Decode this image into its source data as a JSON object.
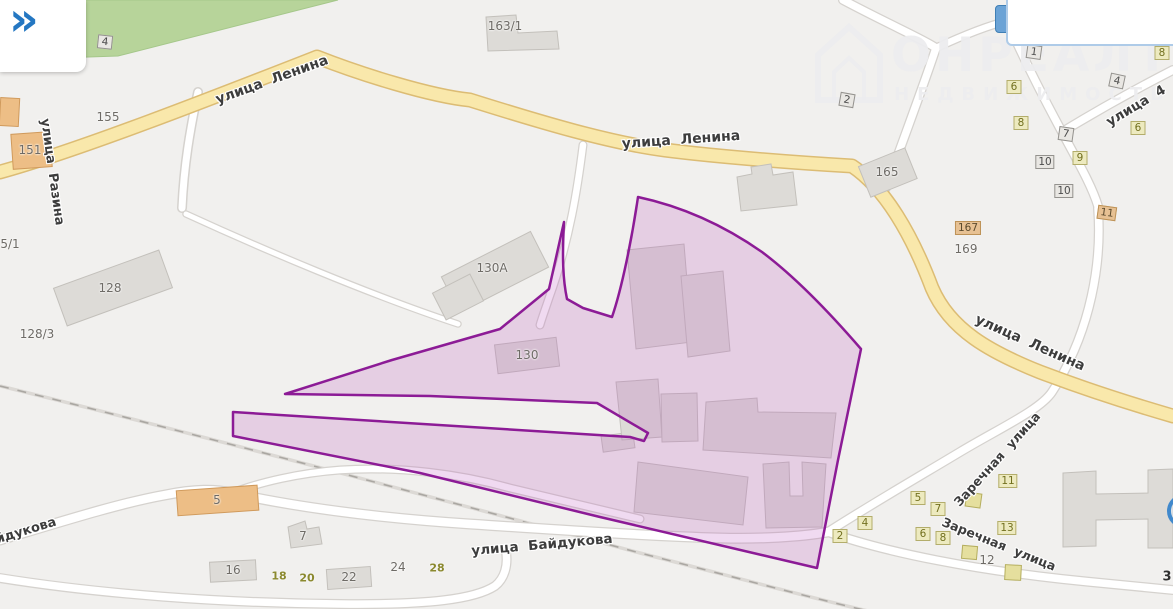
{
  "app": {
    "panel_toggle_icon": "»",
    "watermark": {
      "line1": "ОНРЕАЛТ",
      "line2": "НЕДВИЖИМОСТЬ"
    }
  },
  "colors": {
    "background": "#f1f0ee",
    "selected_area_stroke": "#8c1b96",
    "selected_area_fill": "rgba(186,85,190,0.22)",
    "road_primary_fill": "#f9e8ab",
    "road_primary_casing": "#dcbc74",
    "greenery": "#b7d49a",
    "building": "#dddbd7",
    "building_orange": "#edbe86",
    "accent_blue": "#2477c2"
  },
  "map": {
    "street_labels": [
      {
        "text": "улица Ленина",
        "x": 272,
        "y": 80,
        "rot": -20,
        "size": 14
      },
      {
        "text": "улица Ленина",
        "x": 681,
        "y": 140,
        "rot": -4,
        "size": 14
      },
      {
        "text": "улица Ленина",
        "x": 1030,
        "y": 343,
        "rot": 24,
        "size": 14
      },
      {
        "text": "улица Разина",
        "x": 52,
        "y": 172,
        "rot": 82,
        "size": 13
      },
      {
        "text": "улица Байдукова",
        "x": 542,
        "y": 545,
        "rot": -5,
        "size": 13.5
      },
      {
        "text": "йдукова",
        "x": 26,
        "y": 531,
        "rot": -17,
        "size": 13
      },
      {
        "text": "Заречная улица",
        "x": 997,
        "y": 459,
        "rot": -48,
        "size": 12.5
      },
      {
        "text": "Заречная улица",
        "x": 999,
        "y": 544,
        "rot": 22,
        "size": 12.5
      },
      {
        "text": "улица 4",
        "x": 1136,
        "y": 106,
        "rot": -31,
        "size": 13.5
      }
    ],
    "number_markers": [
      {
        "text": "10",
        "x": 9,
        "y": 42,
        "style": "g",
        "rot": 6
      },
      {
        "text": "8",
        "x": 36,
        "y": 42,
        "style": "g",
        "rot": 6
      },
      {
        "text": "6",
        "x": 68,
        "y": 36,
        "style": "g",
        "rot": -8
      },
      {
        "text": "4",
        "x": 105,
        "y": 42,
        "style": "g",
        "rot": 6
      },
      {
        "text": "2",
        "x": 847,
        "y": 100,
        "style": "g",
        "rot": 10
      },
      {
        "text": "1",
        "x": 1034,
        "y": 52,
        "style": "g",
        "rot": 8
      },
      {
        "text": "4",
        "x": 1117,
        "y": 81,
        "style": "g",
        "rot": 12
      },
      {
        "text": "7",
        "x": 1066,
        "y": 134,
        "style": "g",
        "rot": 8
      },
      {
        "text": "10",
        "x": 1045,
        "y": 162,
        "style": "g",
        "rot": 0
      },
      {
        "text": "10",
        "x": 1064,
        "y": 191,
        "style": "g",
        "rot": 0
      },
      {
        "text": "6",
        "x": 1014,
        "y": 87,
        "style": "o",
        "rot": 0
      },
      {
        "text": "8",
        "x": 1021,
        "y": 123,
        "style": "o",
        "rot": 0
      },
      {
        "text": "8",
        "x": 1162,
        "y": 53,
        "style": "o",
        "rot": 0
      },
      {
        "text": "6",
        "x": 1138,
        "y": 128,
        "style": "o",
        "rot": 0
      },
      {
        "text": "9",
        "x": 1080,
        "y": 158,
        "style": "o",
        "rot": 0
      },
      {
        "text": "5",
        "x": 918,
        "y": 498,
        "style": "o",
        "rot": 0
      },
      {
        "text": "7",
        "x": 938,
        "y": 509,
        "style": "o",
        "rot": 0
      },
      {
        "text": "4",
        "x": 865,
        "y": 523,
        "style": "o",
        "rot": 0
      },
      {
        "text": "2",
        "x": 840,
        "y": 536,
        "style": "o",
        "rot": 0
      },
      {
        "text": "6",
        "x": 923,
        "y": 534,
        "style": "o",
        "rot": 0
      },
      {
        "text": "8",
        "x": 943,
        "y": 538,
        "style": "o",
        "rot": 0
      },
      {
        "text": "11",
        "x": 1008,
        "y": 481,
        "style": "o",
        "rot": 0
      },
      {
        "text": "13",
        "x": 1007,
        "y": 528,
        "style": "o",
        "rot": 0
      },
      {
        "text": "11",
        "x": 1107,
        "y": 213,
        "style": "t",
        "rot": 8
      },
      {
        "text": "167",
        "x": 968,
        "y": 228,
        "style": "t",
        "rot": 0
      },
      {
        "text": "169",
        "x": 966,
        "y": 249,
        "style": "p",
        "rot": 0
      },
      {
        "text": "155",
        "x": 108,
        "y": 117,
        "style": "p",
        "rot": 0
      },
      {
        "text": "5/1",
        "x": 10,
        "y": 244,
        "style": "p",
        "rot": 0
      },
      {
        "text": "151",
        "x": 30,
        "y": 150,
        "style": "p",
        "rot": 0
      },
      {
        "text": "128",
        "x": 110,
        "y": 288,
        "style": "p",
        "rot": 0
      },
      {
        "text": "128/3",
        "x": 37,
        "y": 334,
        "style": "p",
        "rot": 0
      },
      {
        "text": "163/1",
        "x": 505,
        "y": 26,
        "style": "p",
        "rot": 0
      },
      {
        "text": "130А",
        "x": 492,
        "y": 268,
        "style": "p",
        "rot": 0
      },
      {
        "text": "130",
        "x": 527,
        "y": 355,
        "style": "p",
        "rot": 0
      },
      {
        "text": "165",
        "x": 887,
        "y": 172,
        "style": "p",
        "rot": 0
      },
      {
        "text": "5",
        "x": 217,
        "y": 500,
        "style": "p",
        "rot": 0
      },
      {
        "text": "7",
        "x": 303,
        "y": 536,
        "style": "p",
        "rot": 0
      },
      {
        "text": "16",
        "x": 233,
        "y": 570,
        "style": "p",
        "rot": 0
      },
      {
        "text": "22",
        "x": 349,
        "y": 577,
        "style": "p",
        "rot": 0
      },
      {
        "text": "24",
        "x": 398,
        "y": 567,
        "style": "p",
        "rot": 0
      },
      {
        "text": "12",
        "x": 987,
        "y": 560,
        "style": "p",
        "rot": 0
      },
      {
        "text": "18",
        "x": 279,
        "y": 576,
        "style": "po",
        "rot": 0
      },
      {
        "text": "20",
        "x": 307,
        "y": 578,
        "style": "po",
        "rot": 0
      },
      {
        "text": "28",
        "x": 437,
        "y": 568,
        "style": "po",
        "rot": 0
      },
      {
        "text": "3",
        "x": 1167,
        "y": 577,
        "style": "pd",
        "rot": 0
      }
    ],
    "selected_area": {
      "name": "selected-parcel",
      "stroke": "#8c1b96"
    }
  }
}
